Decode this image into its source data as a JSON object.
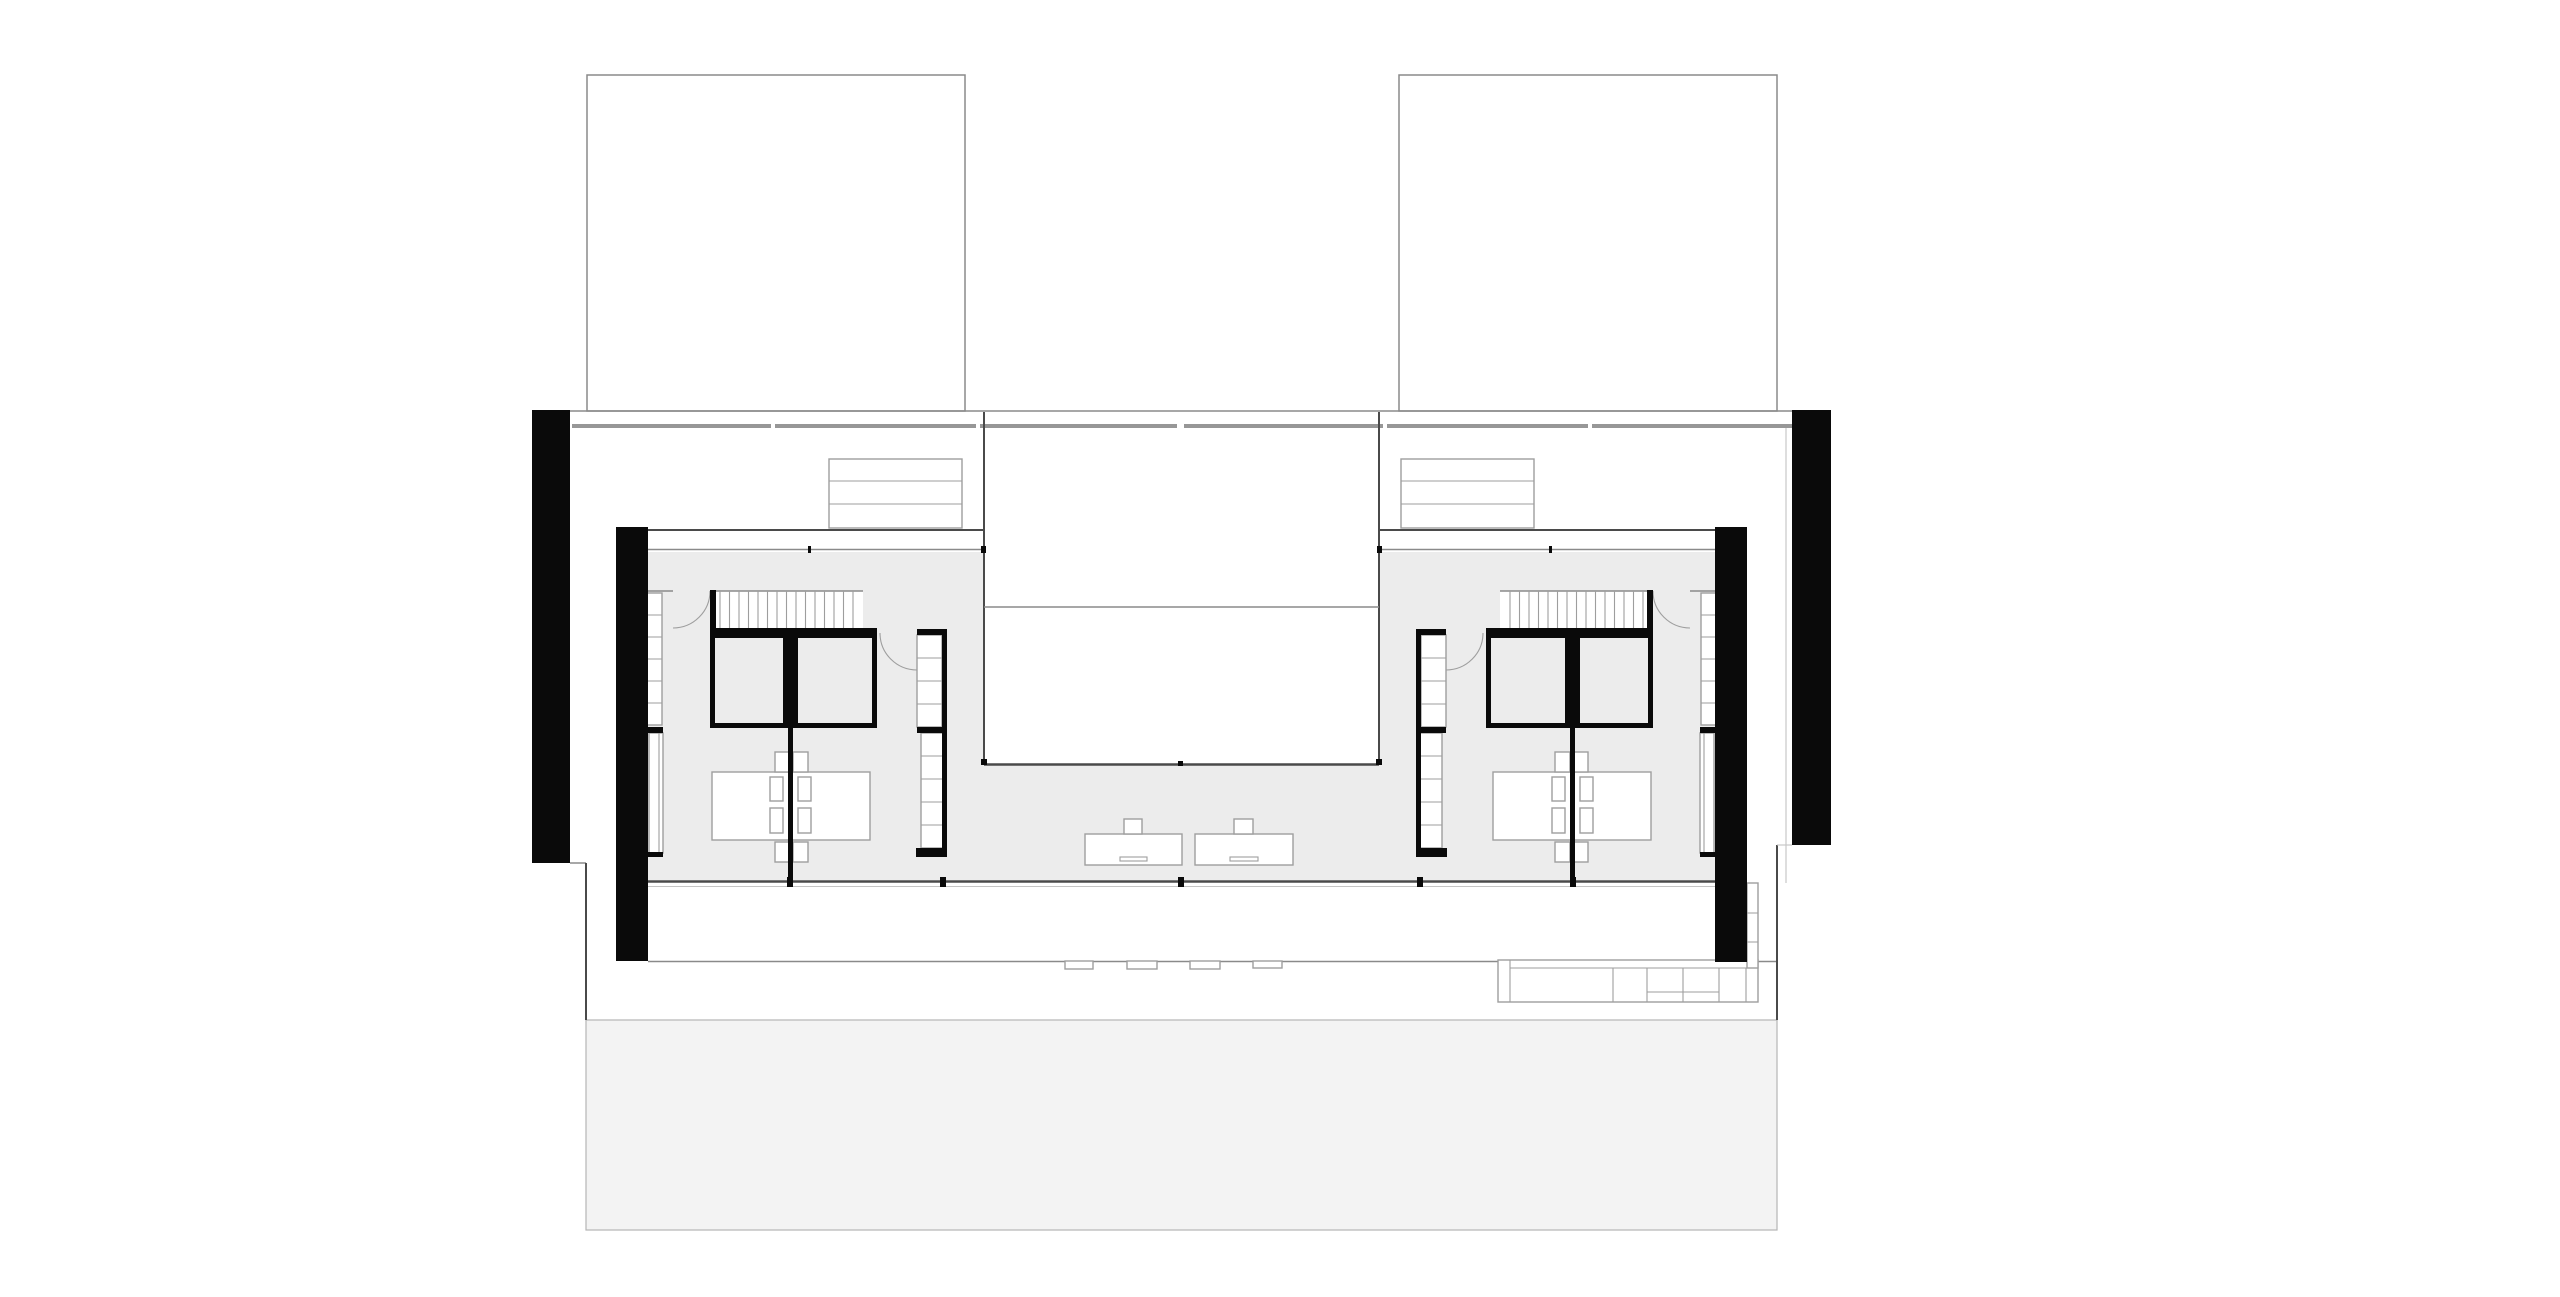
{
  "drawing": {
    "type": "architectural-floor-plan",
    "colors": {
      "background": "#ffffff",
      "wall_black": "#0a0a0a",
      "floor_gray": "#ececec",
      "terrace_gray": "#f3f3f3",
      "line_strong": "#4a4a4a",
      "line_medium": "#8a8a8a",
      "line_light": "#9e9e9e",
      "facade_band": "#979797"
    },
    "inventory": {
      "upper_roof_volumes": 2,
      "black_pier_columns": 4,
      "suites": 2,
      "bedroom_pods_per_suite": 2,
      "stair_flights": 2,
      "stair_treads_per_flight": 15,
      "hall_closets": 2,
      "hall_closet_shelf_rows": 3,
      "beds": 2,
      "pillows_per_bed": 4,
      "nightstands": 8,
      "wardrobe_runs": 8,
      "courtyard_voids": 1,
      "basin_units": 2,
      "basin_faucets": 2,
      "exterior_step_pads": 4,
      "kitchen_counter_segments": 7,
      "terraces": 1
    }
  }
}
